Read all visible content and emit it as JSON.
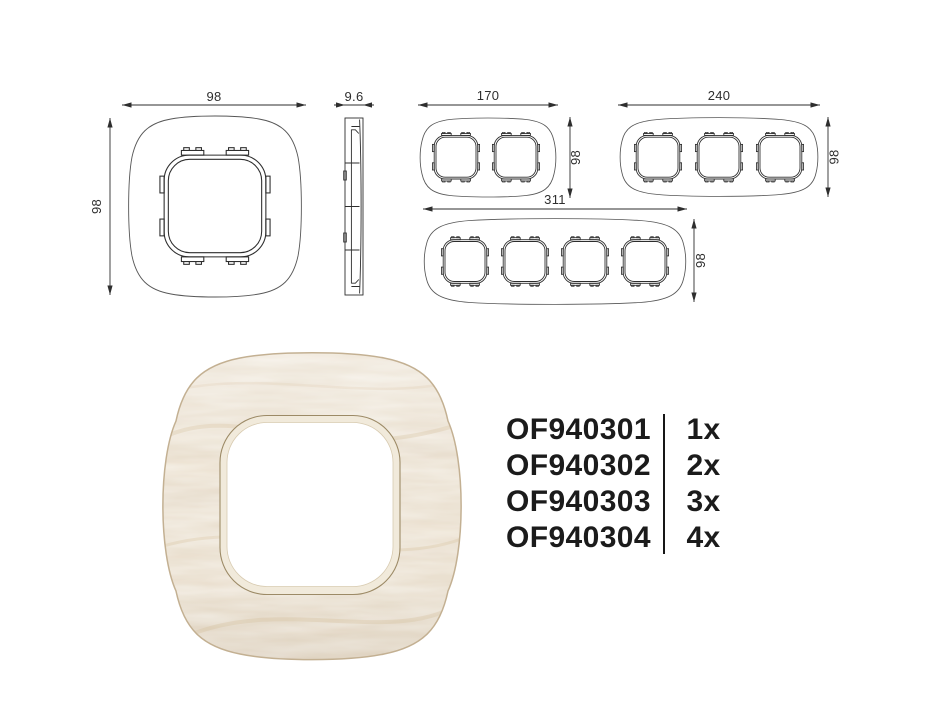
{
  "colors": {
    "background": "#ffffff",
    "drawing_line": "#2e2e2e",
    "text": "#1b1b1b",
    "wood_base": "#e9dfd0",
    "wood_grain": "#d7c29f",
    "wood_highlight": "#f8f4ec",
    "inner_lip": "#f1eadb",
    "lip_outline": "#9c8a66"
  },
  "drawings": {
    "single_front": {
      "width_mm": "98",
      "height_mm": "98"
    },
    "side_profile": {
      "depth_mm": "9.6"
    },
    "double_front": {
      "width_mm": "170",
      "height_mm": "98"
    },
    "triple_front": {
      "width_mm": "240",
      "height_mm": "98"
    },
    "quad_front": {
      "width_mm": "311",
      "height_mm": "98"
    }
  },
  "order_list": {
    "items": [
      {
        "code": "OF940301",
        "qty": "1x"
      },
      {
        "code": "OF940302",
        "qty": "2x"
      },
      {
        "code": "OF940303",
        "qty": "3x"
      },
      {
        "code": "OF940304",
        "qty": "4x"
      }
    ]
  }
}
